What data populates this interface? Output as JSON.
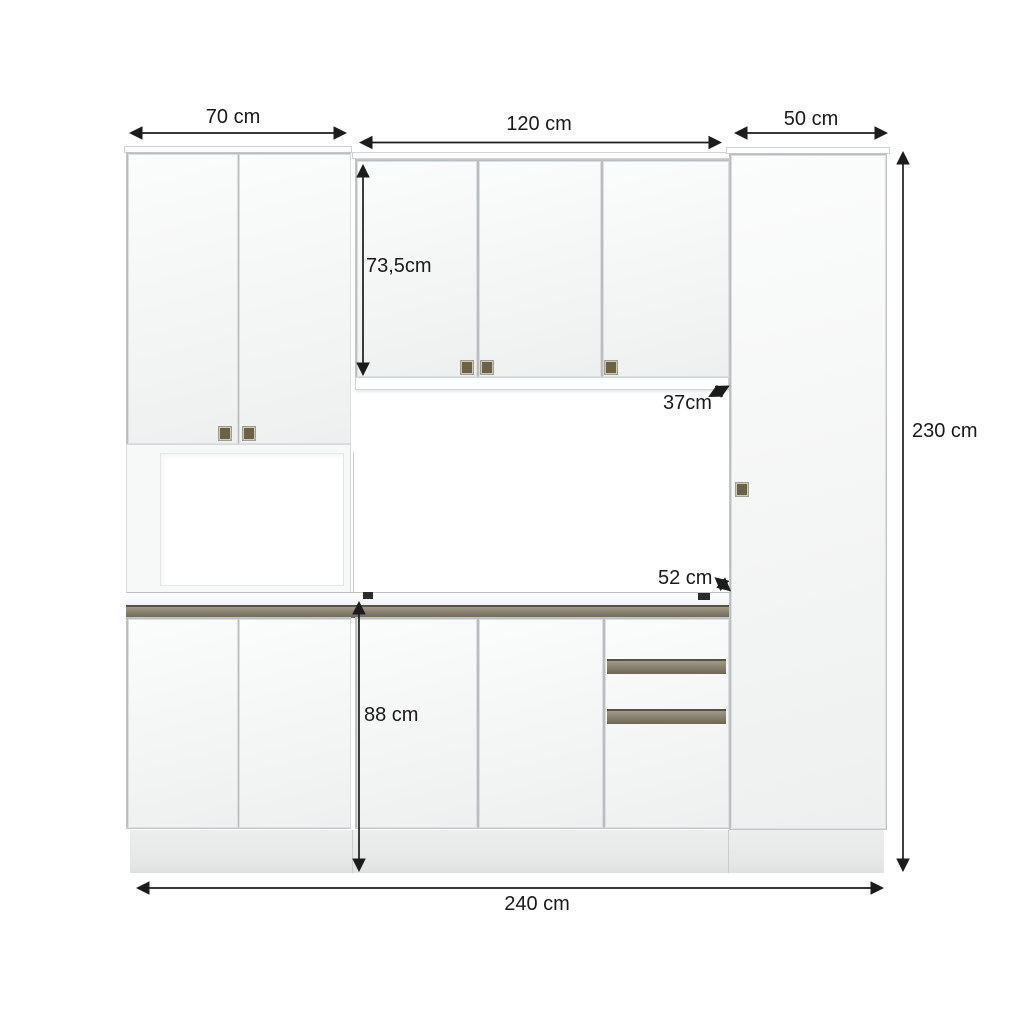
{
  "diagram": {
    "subject": "kitchen-cabinet-set-front-view-with-dimensions",
    "unit_system": "cm",
    "sections": [
      "left-tall-unit-70cm",
      "middle-unit-120cm",
      "right-tall-cabinet-50cm"
    ]
  },
  "dimension_labels": {
    "left_cabinet_width": "70 cm",
    "middle_cabinet_width": "120 cm",
    "right_cabinet_width": "50 cm",
    "wall_cabinet_height": "73,5cm",
    "wall_cabinet_depth": "37cm",
    "total_height": "230 cm",
    "countertop_depth": "52 cm",
    "base_section_height": "88 cm",
    "total_width": "240 cm"
  },
  "colors": {
    "background": "#ffffff",
    "cabinet_face": "#f4f5f5",
    "counter_edge_strip": "#8a8270",
    "drawer_handle_strip": "#8a8270",
    "handle_square": "#6b6147",
    "plinth": "#e8eaea",
    "dimension_lines": "#1c1c1c"
  }
}
